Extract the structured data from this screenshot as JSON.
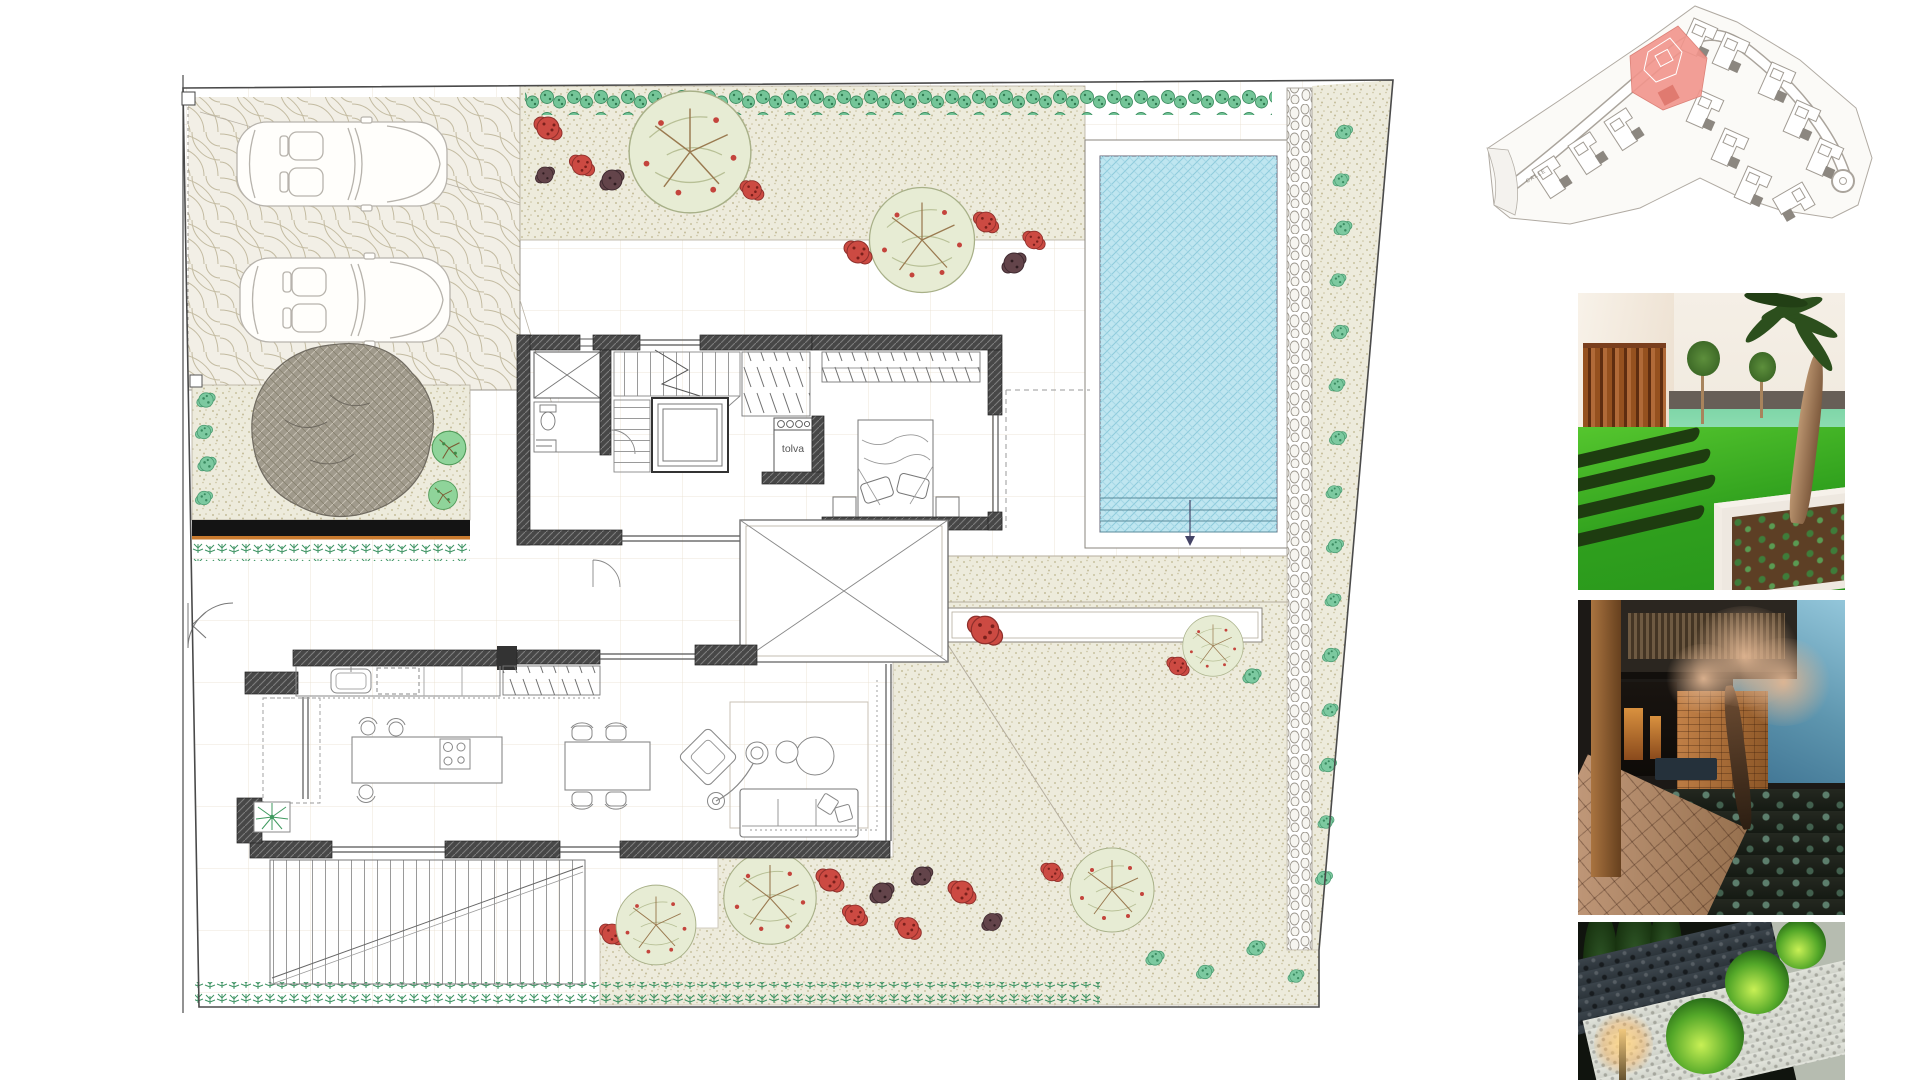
{
  "plan": {
    "labels": {
      "hopper_shaft": "tolva"
    },
    "colors": {
      "pool_water": "#bfe6f0",
      "pool_hatch": "#8ecbdc",
      "wall_dark": "#3f3f3f",
      "pergola_black": "#141414",
      "accent_orange": "#c97a2e",
      "stipple_ground": "#edebdc",
      "hedge_green": "#74c598",
      "fern_green": "#3f9464",
      "tree_gray": "#a09a8c",
      "tree_red": "#cc4a42",
      "tree_dark": "#63444a",
      "boundary_line": "#4a4a4a"
    }
  },
  "site_plan": {
    "road_label": "CALLE",
    "highlight_color": "#f2958c"
  },
  "photos": [
    {
      "id": "garden-hedges",
      "alt": "Garden with lawn, clipped hedge rows, timber slat screen and raised planter"
    },
    {
      "id": "courtyard-dusk",
      "alt": "Villa courtyard at dusk with olive tree, stone wall and warm lighting"
    },
    {
      "id": "night-path",
      "alt": "Night path with illuminated round shrubs, pebbles and bollard light"
    }
  ]
}
